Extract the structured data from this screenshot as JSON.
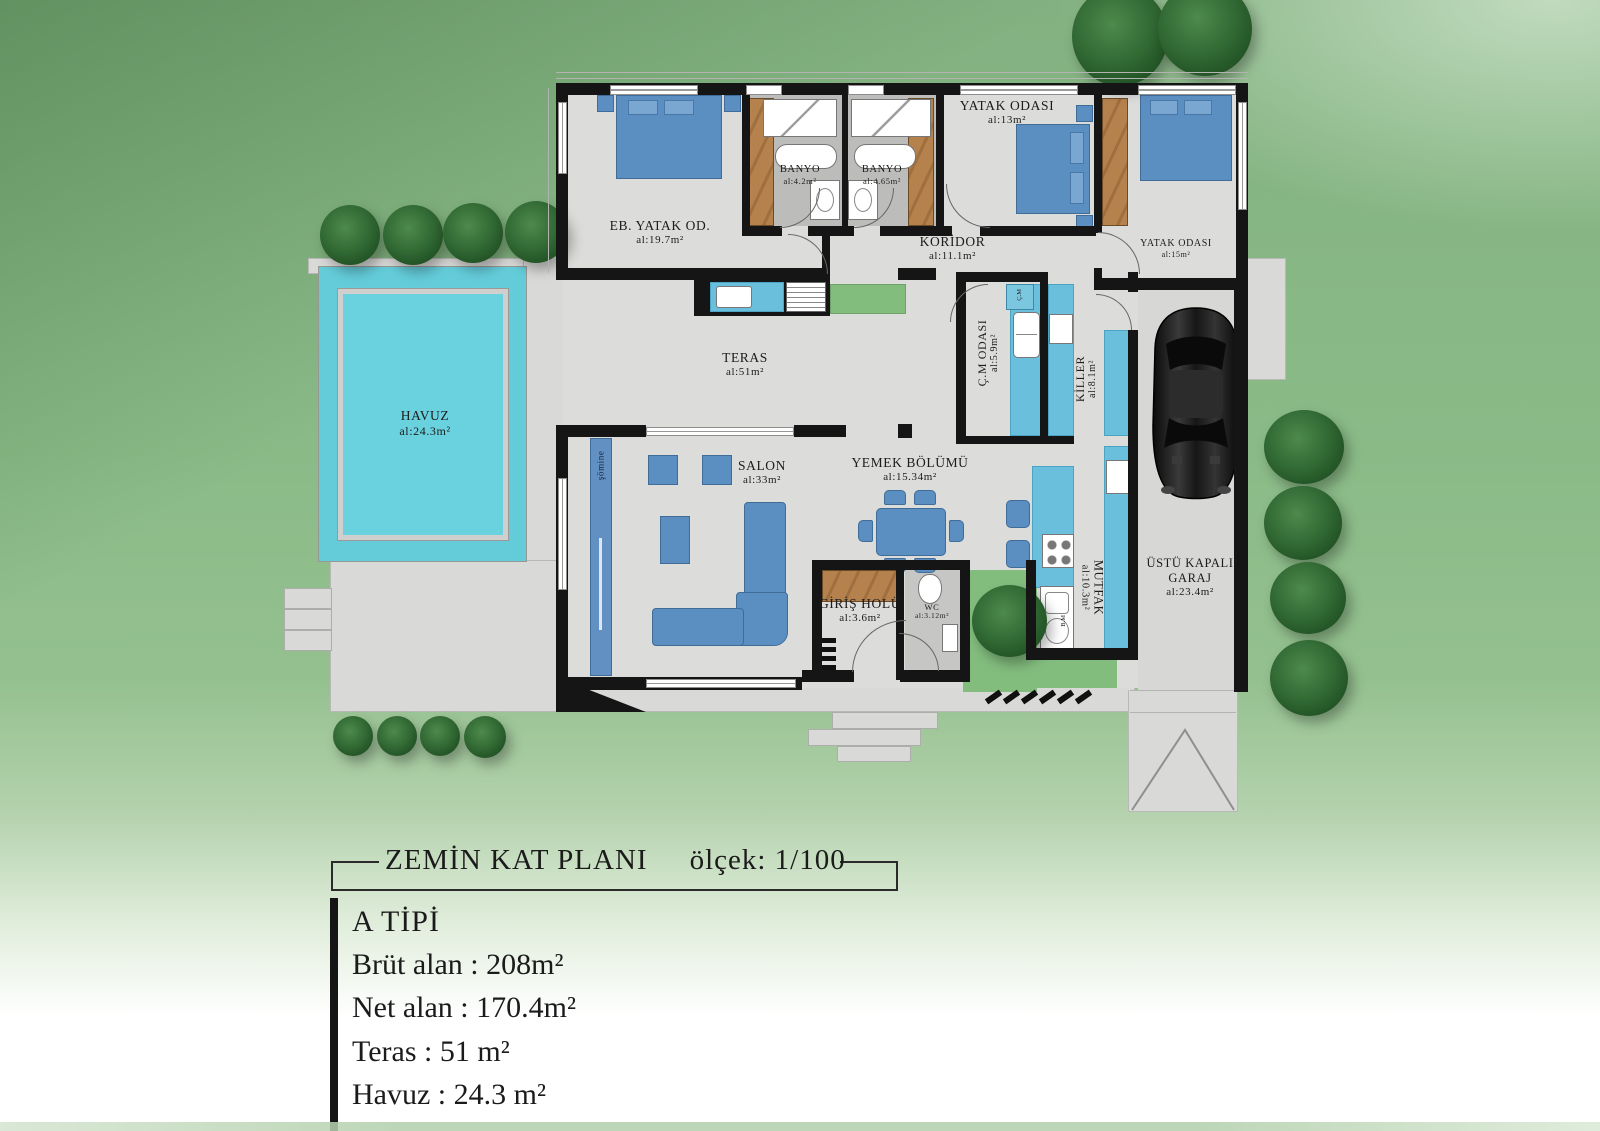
{
  "title_block": {
    "plan_title": "ZEMİN KAT PLANI",
    "scale": "ölçek: 1/100"
  },
  "info_block": {
    "type_label": "A TİPİ",
    "gross_area": "Brüt alan : 208m²",
    "net_area": "Net alan : 170.4m²",
    "terrace_area": "Teras : 51 m²",
    "pool_area": "Havuz : 24.3 m²"
  },
  "rooms": {
    "master_bedroom": {
      "name": "EB. YATAK OD.",
      "area": "al:19.7m²"
    },
    "bathroom_1": {
      "name": "BANYO",
      "area": "al:4.2m²"
    },
    "bathroom_2": {
      "name": "BANYO",
      "area": "al:4.65m²"
    },
    "bedroom_2": {
      "name": "YATAK ODASI",
      "area": "al:13m²"
    },
    "bedroom_3": {
      "name": "YATAK ODASI",
      "area": "al:15m²"
    },
    "corridor": {
      "name": "KORİDOR",
      "area": "al:11.1m²"
    },
    "terrace": {
      "name": "TERAS",
      "area": "al:51m²"
    },
    "pool": {
      "name": "HAVUZ",
      "area": "al:24.3m²"
    },
    "laundry_room": {
      "name": "Ç.M ODASI",
      "area": "al:5.9m²"
    },
    "pantry": {
      "name": "KİLLER",
      "area": "al:8.1m²"
    },
    "living_room": {
      "name": "SALON",
      "area": "al:33m²"
    },
    "dining_area": {
      "name": "YEMEK BÖLÜMÜ",
      "area": "al:15.34m²"
    },
    "kitchen": {
      "name": "MUTFAK",
      "area": "al:10.3m²"
    },
    "entry_hall": {
      "name": "GİRİŞ HOLÜ",
      "area": "al:3.6m²"
    },
    "wc": {
      "name": "WC",
      "area": "al:3.12m²"
    },
    "garage": {
      "name": "ÜSTÜ KAPALI GARAJ",
      "area": "al:23.4m²"
    }
  },
  "labels": {
    "fireplace": "şömine",
    "washing_machine": "Ç.M",
    "dishwasher": "B.M"
  },
  "colors": {
    "lawn": "#8abb87",
    "floor": "#dcdcda",
    "deck": "#d9d9d7",
    "wall": "#151515",
    "water": "#64ccd9",
    "furniture_blue": "#5c8fc1",
    "counter_blue": "#6abfdc",
    "wood": "#b5824e",
    "bath_floor": "#bcbcba",
    "grass_patch": "#83bd7e"
  }
}
